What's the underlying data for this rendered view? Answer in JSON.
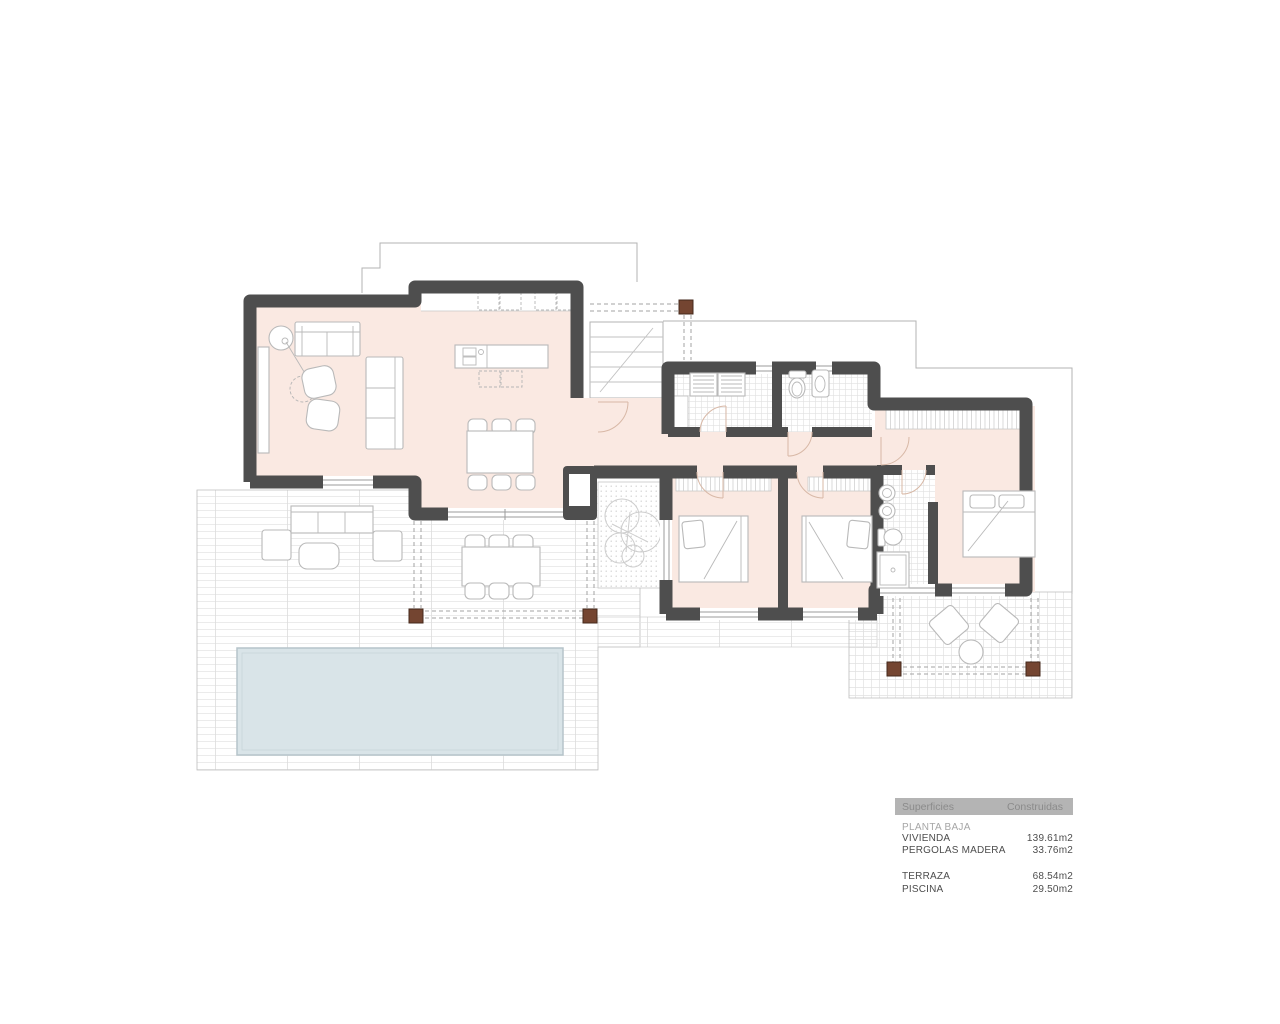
{
  "colors": {
    "wall": "#4e4e4e",
    "room_fill": "#fae9e2",
    "pool_fill": "#d9e4e8",
    "pool_edge": "#b6c4ca",
    "post_brown": "#744531",
    "outline": "#b3b3b3",
    "furniture": "#b9b9b9",
    "arc": "#d8b8a6",
    "legend_header_bg": "#b4b4b4",
    "legend_header_text": "#8b8b8b",
    "legend_muted_text": "#a6a6a6",
    "legend_text": "#4d4d4d"
  },
  "plan": {
    "type": "architectural-floor-plan",
    "elements": [
      "living-dining-kitchen",
      "hallway",
      "laundry",
      "bathroom",
      "bedroom-1",
      "bedroom-2",
      "master-bedroom",
      "ensuite-bathroom",
      "swimming-pool",
      "terrace",
      "wood-pergola",
      "entrance-stairs",
      "tree-patio",
      "outdoor-lounge",
      "outdoor-dining"
    ]
  },
  "legend": {
    "header": {
      "col1": "Superficies",
      "col2": "Construidas"
    },
    "section_label": "PLANTA BAJA",
    "rows": [
      {
        "label": "VIVIENDA",
        "value": "139.61m2"
      },
      {
        "label": "PERGOLAS MADERA",
        "value": "33.76m2"
      },
      {
        "label": "TERRAZA",
        "value": "68.54m2"
      },
      {
        "label": "PISCINA",
        "value": "29.50m2"
      }
    ]
  }
}
